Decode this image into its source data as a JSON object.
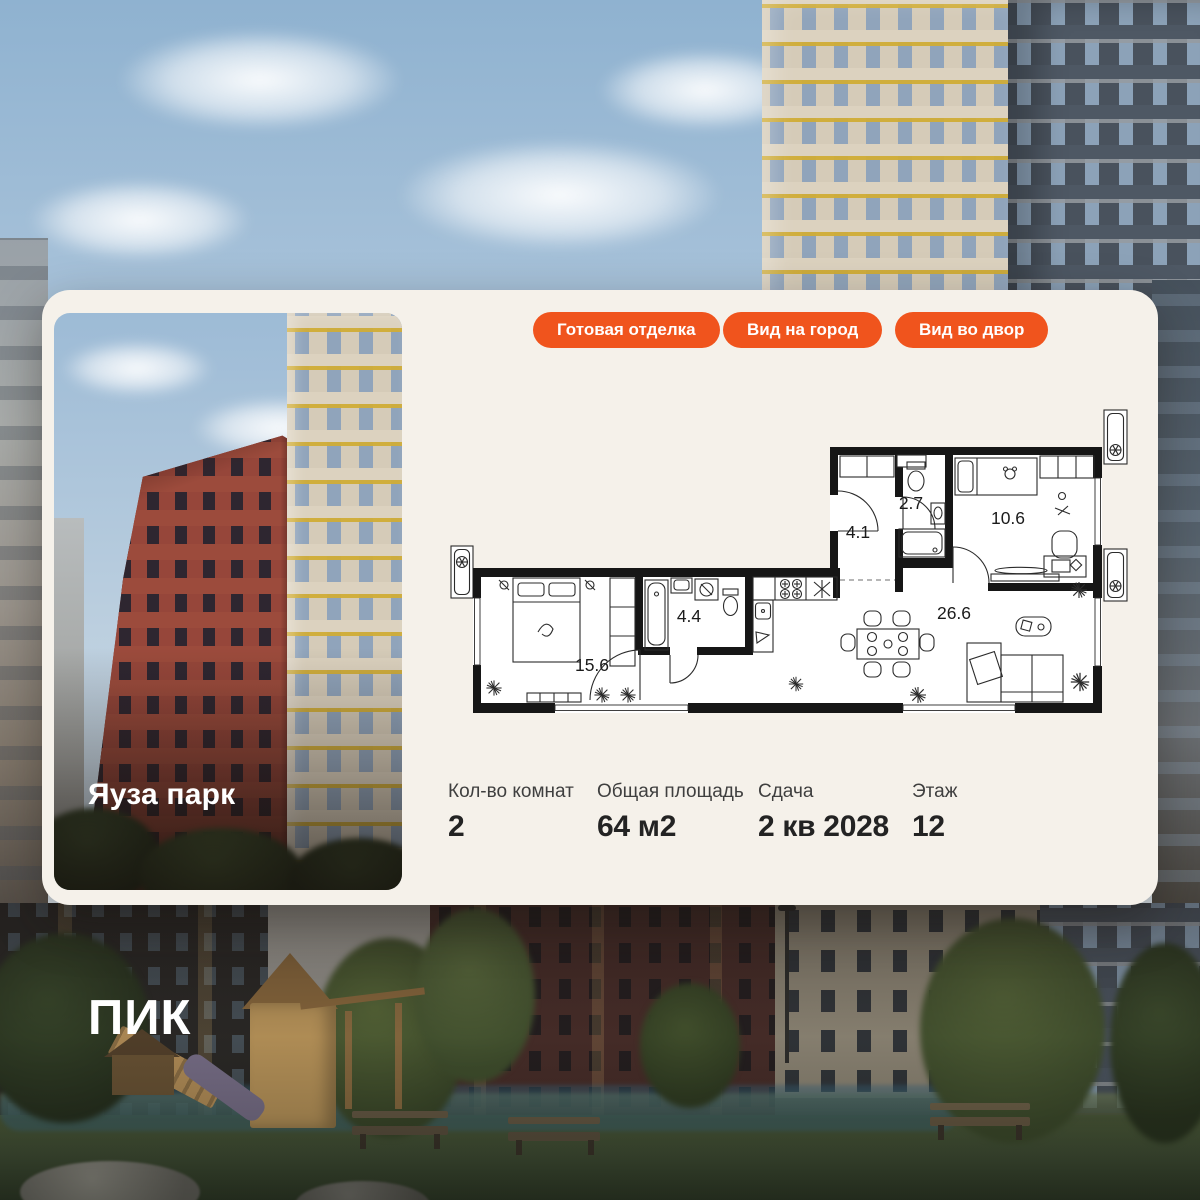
{
  "brand": {
    "logo_text": "ПИК"
  },
  "card": {
    "project_name": "Яуза парк",
    "badges": [
      {
        "label": "Готовая отделка"
      },
      {
        "label": "Вид на город"
      },
      {
        "label": "Вид во двор"
      }
    ],
    "floorplan": {
      "rooms": [
        {
          "name": "hallway",
          "area": "4.1"
        },
        {
          "name": "wc",
          "area": "2.7"
        },
        {
          "name": "bedroom-small",
          "area": "10.6"
        },
        {
          "name": "bathroom",
          "area": "4.4"
        },
        {
          "name": "bedroom",
          "area": "15.6"
        },
        {
          "name": "kitchen-living",
          "area": "26.6"
        }
      ]
    },
    "stats": [
      {
        "label": "Кол-во комнат",
        "value": "2"
      },
      {
        "label": "Общая площадь",
        "value": "64 м2"
      },
      {
        "label": "Сдача",
        "value": "2 кв 2028"
      },
      {
        "label": "Этаж",
        "value": "12"
      }
    ]
  },
  "colors": {
    "accent": "#F0541D",
    "card_bg": "#F5F1EA",
    "wall": "#161616"
  }
}
